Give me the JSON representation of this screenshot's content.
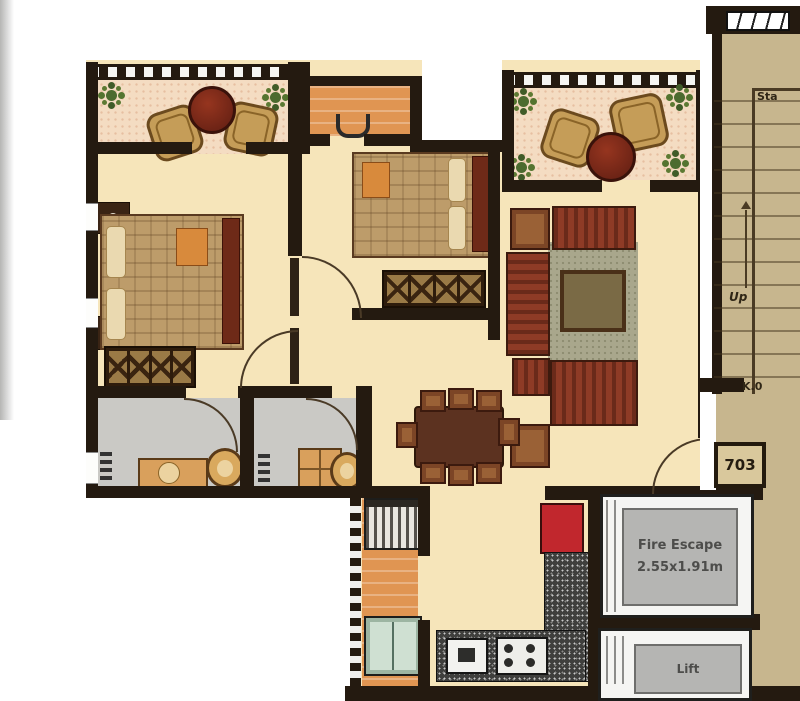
{
  "labels": {
    "staircase": "Sta",
    "up": "Up",
    "landing": "K.0",
    "unit_number": "703",
    "fire_escape": "Fire Escape",
    "fire_escape_size": "2.55x1.91m",
    "lift": "Lift"
  },
  "colors": {
    "wall": "#241a10",
    "floor_cream": "#f6e5ba",
    "balcony_floor": "#f4dcc2",
    "utility_orange": "#e09552",
    "stair_tan": "#c7b68e",
    "bathroom_gray": "#cac9c5",
    "sofa_maroon": "#8e3b26",
    "fridge_red": "#c1272d",
    "rug_green": "#a9a78c",
    "furniture_brown": "#5c3220",
    "escape_gray": "#b4b3b0"
  }
}
